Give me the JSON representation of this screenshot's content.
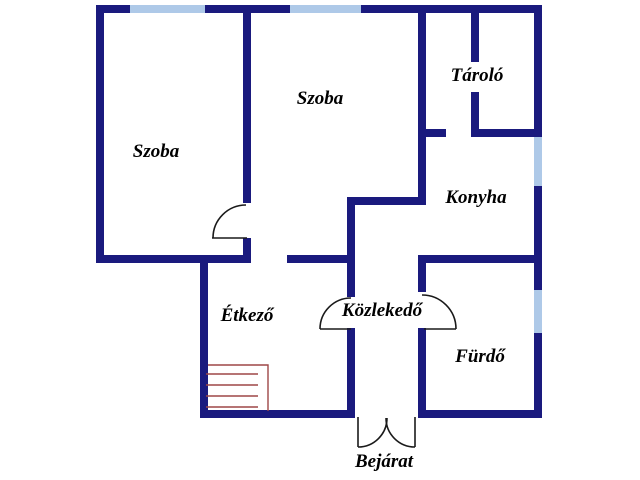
{
  "floor_plan": {
    "rooms": [
      {
        "id": "szoba-1",
        "label": "Szoba"
      },
      {
        "id": "szoba-2",
        "label": "Szoba"
      },
      {
        "id": "tarolo",
        "label": "Tároló"
      },
      {
        "id": "konyha",
        "label": "Konyha"
      },
      {
        "id": "etkezo",
        "label": "Étkező"
      },
      {
        "id": "kozlekedo",
        "label": "Közlekedő"
      },
      {
        "id": "furdo",
        "label": "Fürdő"
      },
      {
        "id": "bejarat",
        "label": "Bejárat"
      }
    ],
    "features": {
      "windows": [
        "top-wall-left-szoba",
        "top-wall-middle-szoba",
        "right-wall-konyha",
        "right-wall-furdo"
      ],
      "doors": [
        "szoba-divider-door",
        "etkezo-door",
        "furdo-door",
        "entrance-double-door"
      ],
      "stair_treads": 4
    },
    "colors": {
      "wall": "#1a1a7e",
      "window": "#aec9e8",
      "door_line": "#1a1a1a",
      "stairs": "#9e4747",
      "background": "#ffffff",
      "text": "#000000"
    }
  }
}
